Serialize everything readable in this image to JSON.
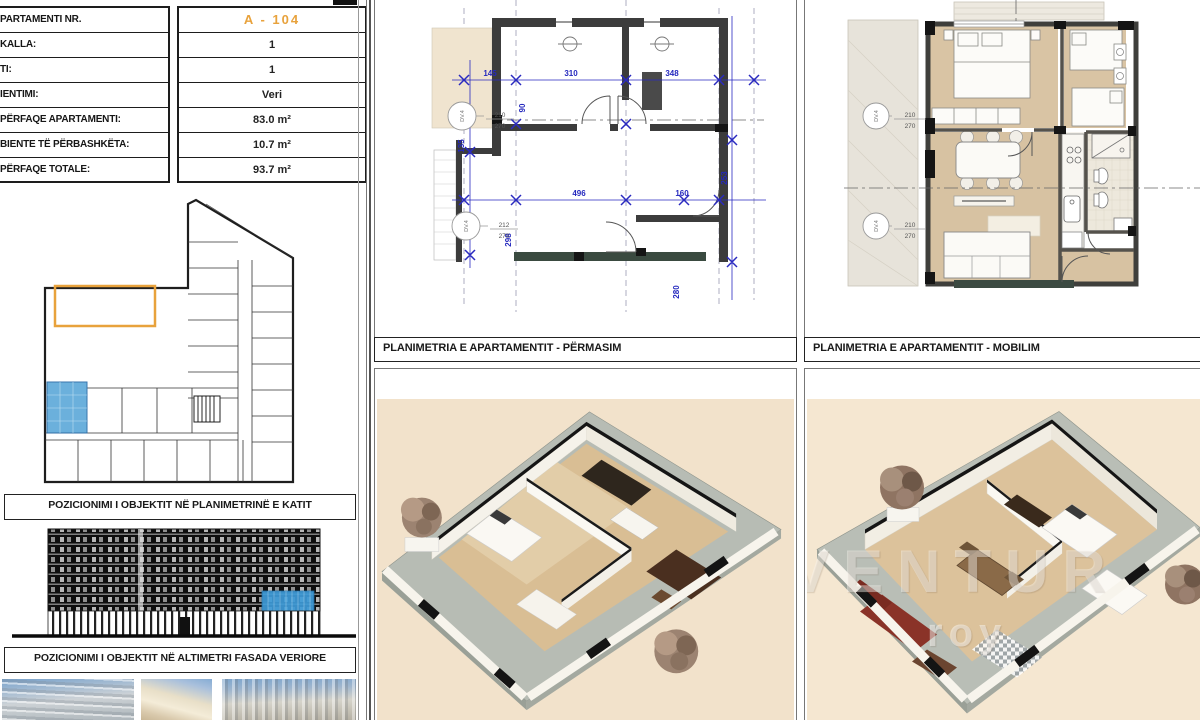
{
  "info_table": {
    "rows": [
      {
        "label": "PARTAMENTI NR.",
        "value": "A - 104"
      },
      {
        "label": "KALLA:",
        "value": "1"
      },
      {
        "label": "TI:",
        "value": "1"
      },
      {
        "label": "IENTIMI:",
        "value": "Veri"
      },
      {
        "label": "PËRFAQE APARTAMENTI:",
        "value": "83.0 m²"
      },
      {
        "label": "BIENTE TË PËRBASHKËTA:",
        "value": "10.7 m²"
      },
      {
        "label": "PËRFAQE TOTALE:",
        "value": "93.7 m²"
      }
    ]
  },
  "captions": {
    "key_plan": "POZICIONIMI I OBJEKTIT NË PLANIMETRINË E KATIT",
    "elevation": "POZICIONIMI I OBJEKTIT NË ALTIMETRI FASADA VERIORE",
    "plan_dimensions": "PLANIMETRIA E APARTAMENTIT - PËRMASIM",
    "plan_furnished": "PLANIMETRIA E APARTAMENTIT - MOBILIM"
  },
  "middle_plan": {
    "dims_top": [
      "145",
      "310",
      "348"
    ],
    "dims_mid": [
      "496",
      "160"
    ],
    "dims_vert": [
      "90",
      "135",
      "298",
      "253",
      "280"
    ],
    "door_tags": [
      {
        "code": "DV.4",
        "width": "210",
        "height": "270"
      },
      {
        "code": "DV.4",
        "width": "212",
        "height": "270"
      }
    ]
  },
  "right_plan": {
    "door_tags": [
      {
        "code": "DV.4",
        "width": "210",
        "height": "270"
      },
      {
        "code": "DV.4",
        "width": "210",
        "height": "270"
      }
    ]
  },
  "watermark": {
    "text": "VENTUR",
    "subtext": "roy"
  },
  "colors": {
    "accent_orange": "#E8A23C",
    "highlight_blue": "#5FA8D8",
    "dim_blue": "#2A2AC0",
    "beige_mid": "#F2E2CB",
    "beige_right": "#F5E7D1"
  }
}
